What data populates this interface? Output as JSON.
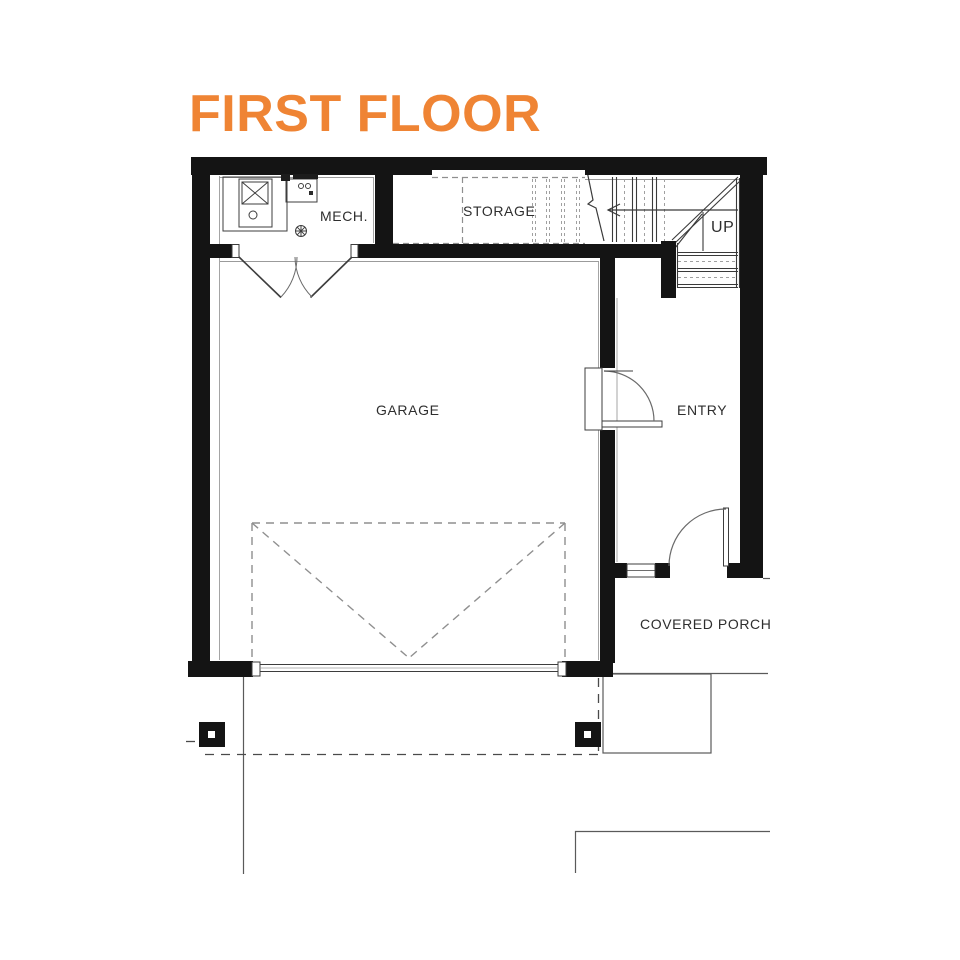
{
  "title": "FIRST FLOOR",
  "colors": {
    "accent_orange": "#EF8434",
    "wall_black": "#141414",
    "line_gray": "#5a5a5a",
    "dashed_gray": "#909090"
  },
  "rooms": {
    "mech": {
      "label": "MECH."
    },
    "storage": {
      "label": "STORAGE"
    },
    "stairs": {
      "label": "UP"
    },
    "garage": {
      "label": "GARAGE"
    },
    "entry": {
      "label": "ENTRY"
    },
    "porch": {
      "label": "COVERED PORCH"
    }
  },
  "symbols": [
    "water-heater-icon",
    "equipment-panel-icon",
    "floor-drain-icon",
    "double-door-symbol",
    "interior-door-symbol",
    "front-door-symbol",
    "overhead-garage-door-symbol",
    "stair-up-arrow",
    "porch-post",
    "sidelite-window"
  ]
}
